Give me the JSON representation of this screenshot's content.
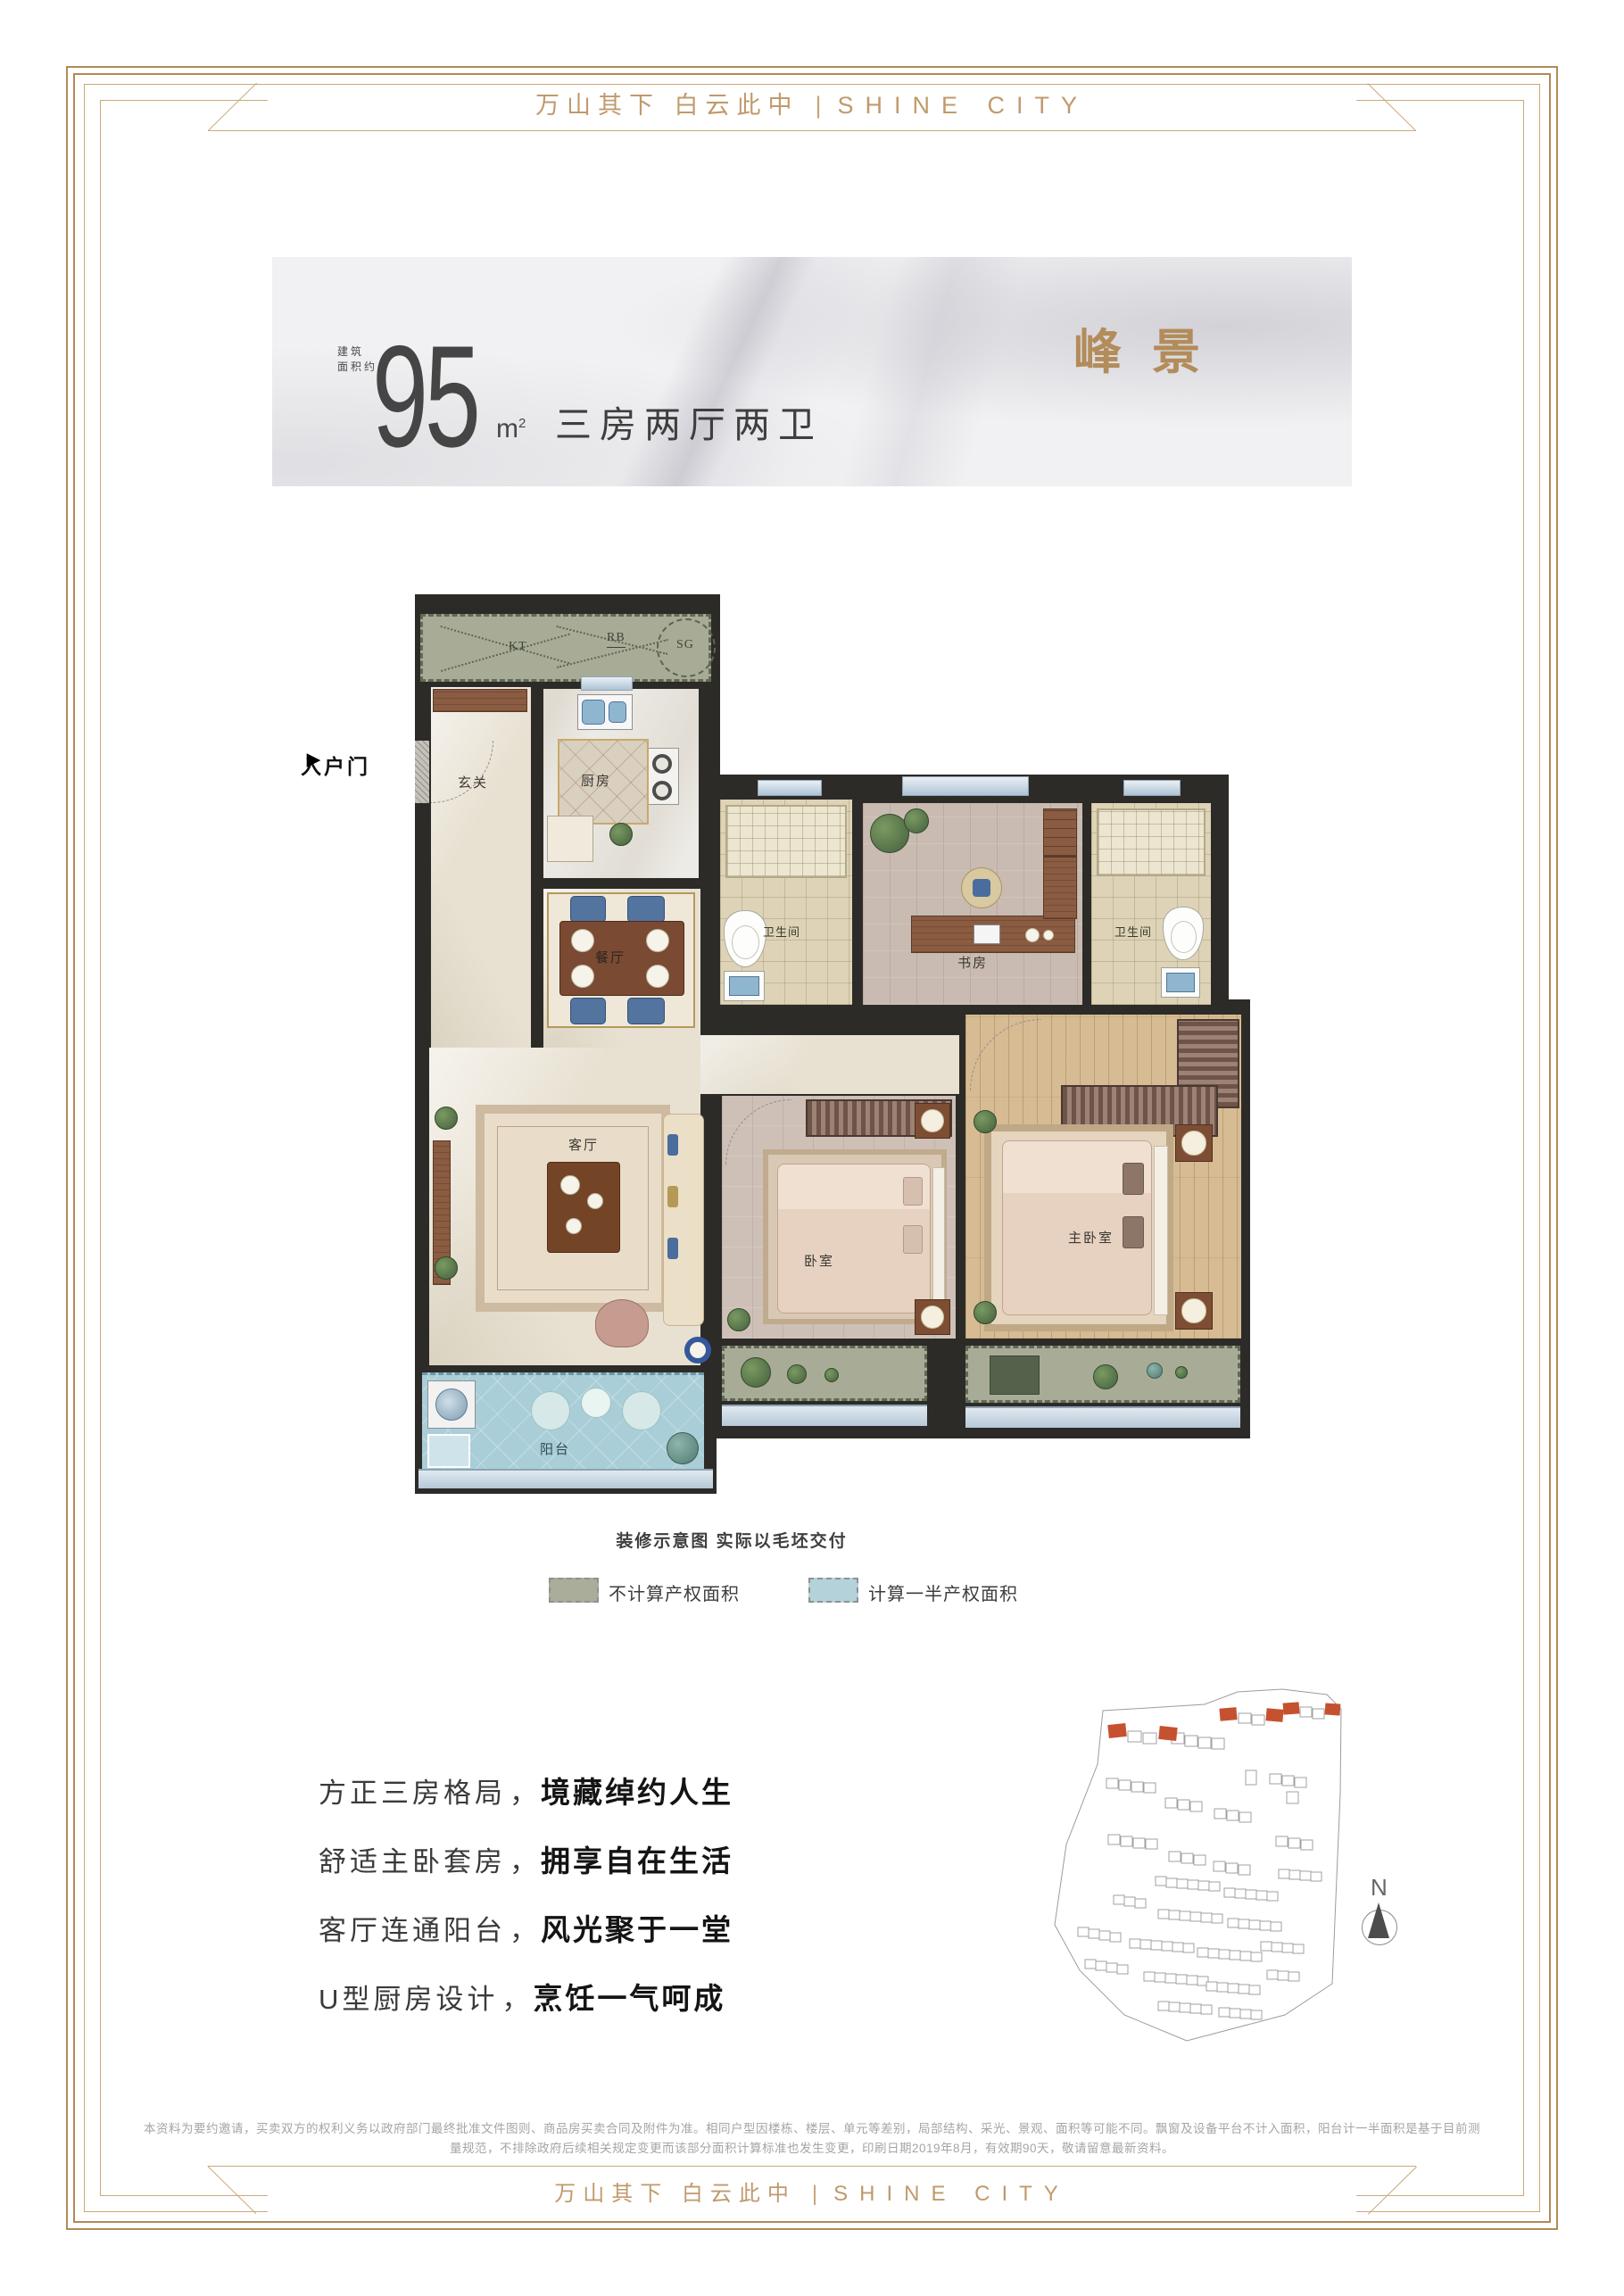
{
  "page": {
    "brand_cn": "万山其下 白云此中",
    "brand_divider": "|",
    "brand_en": "SHINE CITY"
  },
  "banner": {
    "area_label_line1": "建筑",
    "area_label_line2": "面积约",
    "area_value": "95",
    "area_unit": "m",
    "area_unit_sup": "2",
    "layout_text": "三房两厅两卫",
    "unit_name": "峰景"
  },
  "floor_plan": {
    "entry_door": "入户门",
    "entry_arrow": "▶",
    "platform": {
      "kt": "KT",
      "rb": "RB",
      "sg": "SG"
    },
    "rooms": {
      "entry": "玄关",
      "kitchen": "厨房",
      "dining": "餐厅",
      "living": "客厅",
      "balcony": "阳台",
      "bath_left": "卫生间",
      "study": "书房",
      "bath_right": "卫生间",
      "bedroom": "卧室",
      "master_bedroom": "主卧室"
    },
    "caption": "装修示意图 实际以毛坯交付"
  },
  "legend": {
    "items": [
      {
        "label": "不计算产权面积",
        "color": "#a9ad99"
      },
      {
        "label": "计算一半产权面积",
        "color": "#b4d2da"
      }
    ]
  },
  "selling_points": [
    {
      "lead": "方正三房格局",
      "comma": "，",
      "bold": "境藏绰约人生"
    },
    {
      "lead": "舒适主卧套房",
      "comma": "，",
      "bold": "拥享自在生活"
    },
    {
      "lead": "客厅连通阳台",
      "comma": "，",
      "bold": "风光聚于一堂"
    },
    {
      "lead": "U型厨房设计",
      "comma": "，",
      "bold": "烹饪一气呵成"
    }
  ],
  "site_map": {
    "north_label": "N",
    "highlight_color": "#c6512e"
  },
  "disclaimer": {
    "line1": "本资料为要约邀请，买卖双方的权利义务以政府部门最终批准文件图则、商品房买卖合同及附件为准。相同户型因楼栋、楼层、单元等差别，局部结构、采光、景观、面积等可能不同。飘窗及设备平台不计入面积，阳台计一半面积是基于目前测",
    "line2": "量规范，不排除政府后续相关规定变更而该部分面积计算标准也发生变更，印刷日期2019年8月，有效期90天，敬请留意最新资料。"
  },
  "colors": {
    "gold": "#bd9765",
    "text_dark": "#3d3d3d",
    "wall": "#2d2b28",
    "no_property_area": "#a9ad99",
    "half_property_area": "#b4d2da"
  }
}
